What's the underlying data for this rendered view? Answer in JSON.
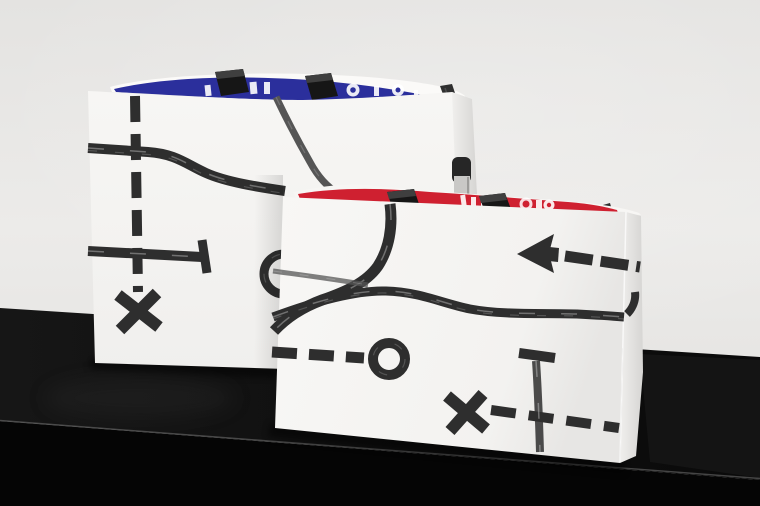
{
  "scene": {
    "type": "studio product photograph",
    "description": "Two white paper shopping bags decorated with hand-painted black map-style route graphics (dashed routes, X crosses, circle markers, an arrow), standing on a glossy black plinth against a light grey studio wall. The larger bag behind has a blue inner rim, the smaller bag in front a red inner rim; partial upside-down white lettering shows on each coloured rim.",
    "objects": [
      "back shopping bag with blue rim",
      "front shopping bag with red rim",
      "black plinth",
      "grey wall"
    ]
  },
  "back_bag": {
    "rim_color_name": "blue",
    "lettering": "partial upside-down white letters, mostly hidden by the fold",
    "handles": "black folded handle tabs and a dark rear strap",
    "marks": [
      "vertical dashed route line",
      "x-cross marker",
      "brushed s-curve route line",
      "route line with T terminus",
      "circle marker half hidden behind front bag",
      "thin curved route line"
    ]
  },
  "front_bag": {
    "rim_color_name": "red",
    "lettering": "partial upside-down white letters, mostly hidden by the fold",
    "handles": "black folded handle tabs and a grey rear strap",
    "marks": [
      "curved route line dropping from rim",
      "wavy horizontal route line",
      "dry-brush grey stroke",
      "dashed line ending in ring marker",
      "left-pointing arrow with dashed tail",
      "x-cross marker",
      "dashed crossing line",
      "T-post with fading stem"
    ]
  },
  "colors": {
    "wall_top": "#e4e3e1",
    "wall_mid": "#ecebe9",
    "wall_bottom": "#e1e0de",
    "plinth_top": "#101010",
    "plinth_front": "#050505",
    "plinth_edge_highlight": "#777777",
    "bag_paper": "#f8f7f5",
    "bag_paper_shade": "#d6d5d3",
    "rim_blue": "#2b2f9c",
    "rim_red": "#cf2030",
    "paint": "#2e2e2e",
    "paint_soft": "#555555",
    "handle_black": "#161616",
    "lettering_white": "#ffffff"
  }
}
